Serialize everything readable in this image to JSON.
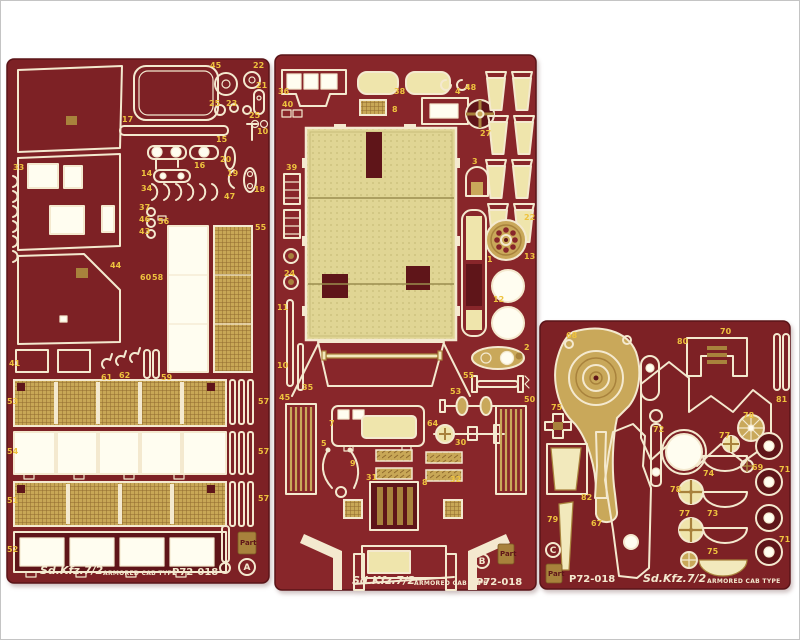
{
  "colors": {
    "fret": "#7d2125",
    "fret2": "#88262a",
    "fretdark": "#5f1519",
    "outline": "#f4e9cf",
    "bright": "#fffdf0",
    "khaki": "#efe5ac",
    "khakibright": "#f2e9bc",
    "gold": "#c9a85a",
    "golddeep": "#a8823c",
    "label": "#eec23e",
    "photobg": "#ffffff",
    "frame": "#c4c4c4"
  },
  "frets": [
    {
      "letter": "A",
      "title": "Sd.Kfz.7/2",
      "subtitle": "ARMORED CAB TYPE",
      "code": "P72-018",
      "brand": "Part",
      "labels": [
        {
          "t": "45",
          "x": 204,
          "y": 10
        },
        {
          "t": "22",
          "x": 247,
          "y": 10
        },
        {
          "t": "21",
          "x": 250,
          "y": 30
        },
        {
          "t": "25",
          "x": 203,
          "y": 48
        },
        {
          "t": "23",
          "x": 220,
          "y": 48
        },
        {
          "t": "25",
          "x": 243,
          "y": 60
        },
        {
          "t": "17",
          "x": 116,
          "y": 64
        },
        {
          "t": "15",
          "x": 210,
          "y": 84
        },
        {
          "t": "10",
          "x": 251,
          "y": 76
        },
        {
          "t": "20",
          "x": 214,
          "y": 104
        },
        {
          "t": "16",
          "x": 188,
          "y": 110
        },
        {
          "t": "19",
          "x": 221,
          "y": 118
        },
        {
          "t": "18",
          "x": 248,
          "y": 134
        },
        {
          "t": "14",
          "x": 135,
          "y": 118
        },
        {
          "t": "34",
          "x": 135,
          "y": 133
        },
        {
          "t": "47",
          "x": 218,
          "y": 141
        },
        {
          "t": "33",
          "x": 7,
          "y": 112
        },
        {
          "t": "37",
          "x": 133,
          "y": 152
        },
        {
          "t": "46",
          "x": 133,
          "y": 164
        },
        {
          "t": "43",
          "x": 133,
          "y": 176
        },
        {
          "t": "56",
          "x": 152,
          "y": 166
        },
        {
          "t": "55",
          "x": 249,
          "y": 172
        },
        {
          "t": "44",
          "x": 104,
          "y": 210
        },
        {
          "t": "60",
          "x": 134,
          "y": 222
        },
        {
          "t": "58",
          "x": 146,
          "y": 222
        },
        {
          "t": "41",
          "x": 3,
          "y": 308
        },
        {
          "t": "61",
          "x": 95,
          "y": 322
        },
        {
          "t": "62",
          "x": 113,
          "y": 320
        },
        {
          "t": "59",
          "x": 155,
          "y": 322
        },
        {
          "t": "53",
          "x": 1,
          "y": 346
        },
        {
          "t": "54",
          "x": 1,
          "y": 396
        },
        {
          "t": "51",
          "x": 1,
          "y": 445
        },
        {
          "t": "52",
          "x": 1,
          "y": 494
        },
        {
          "t": "57",
          "x": 252,
          "y": 346
        },
        {
          "t": "57",
          "x": 252,
          "y": 396
        },
        {
          "t": "57",
          "x": 252,
          "y": 443
        }
      ]
    },
    {
      "letter": "B",
      "title": "Sd.Kfz.7/2",
      "subtitle": "ARMORED CAB TYPE",
      "code": "P72-018",
      "brand": "Part",
      "labels": [
        {
          "t": "36",
          "x": 4,
          "y": 40
        },
        {
          "t": "40",
          "x": 8,
          "y": 53
        },
        {
          "t": "38",
          "x": 120,
          "y": 40
        },
        {
          "t": "8",
          "x": 118,
          "y": 58
        },
        {
          "t": "4",
          "x": 181,
          "y": 40
        },
        {
          "t": "48",
          "x": 191,
          "y": 36
        },
        {
          "t": "27",
          "x": 206,
          "y": 82
        },
        {
          "t": "3",
          "x": 198,
          "y": 110
        },
        {
          "t": "39",
          "x": 12,
          "y": 116
        },
        {
          "t": "24",
          "x": 10,
          "y": 222
        },
        {
          "t": "11",
          "x": 3,
          "y": 256
        },
        {
          "t": "10",
          "x": 3,
          "y": 314
        },
        {
          "t": "22",
          "x": 250,
          "y": 166
        },
        {
          "t": "13",
          "x": 250,
          "y": 205
        },
        {
          "t": "1",
          "x": 213,
          "y": 208
        },
        {
          "t": "12",
          "x": 219,
          "y": 248
        },
        {
          "t": "2",
          "x": 250,
          "y": 296
        },
        {
          "t": "35",
          "x": 28,
          "y": 336
        },
        {
          "t": "45",
          "x": 5,
          "y": 346
        },
        {
          "t": "55",
          "x": 189,
          "y": 324
        },
        {
          "t": "53",
          "x": 176,
          "y": 340
        },
        {
          "t": "50",
          "x": 250,
          "y": 348
        },
        {
          "t": "64",
          "x": 153,
          "y": 372
        },
        {
          "t": "7",
          "x": 55,
          "y": 372
        },
        {
          "t": "5",
          "x": 47,
          "y": 392
        },
        {
          "t": "9",
          "x": 76,
          "y": 412
        },
        {
          "t": "31",
          "x": 92,
          "y": 426
        },
        {
          "t": "30",
          "x": 181,
          "y": 391
        },
        {
          "t": "32",
          "x": 176,
          "y": 428
        },
        {
          "t": "8",
          "x": 148,
          "y": 431
        }
      ]
    },
    {
      "letter": "C",
      "title": "Sd.Kfz.7/2",
      "subtitle": "ARMORED CAB TYPE",
      "code": "P72-018",
      "brand": "Part",
      "labels": [
        {
          "t": "68",
          "x": 27,
          "y": 18
        },
        {
          "t": "70",
          "x": 181,
          "y": 14
        },
        {
          "t": "80",
          "x": 138,
          "y": 24
        },
        {
          "t": "81",
          "x": 237,
          "y": 82
        },
        {
          "t": "75",
          "x": 12,
          "y": 90
        },
        {
          "t": "72",
          "x": 114,
          "y": 112
        },
        {
          "t": "78",
          "x": 204,
          "y": 98
        },
        {
          "t": "77",
          "x": 180,
          "y": 118
        },
        {
          "t": "69",
          "x": 213,
          "y": 150
        },
        {
          "t": "71",
          "x": 240,
          "y": 152
        },
        {
          "t": "74",
          "x": 164,
          "y": 156
        },
        {
          "t": "78",
          "x": 131,
          "y": 172
        },
        {
          "t": "77",
          "x": 140,
          "y": 196
        },
        {
          "t": "73",
          "x": 168,
          "y": 196
        },
        {
          "t": "75",
          "x": 168,
          "y": 234
        },
        {
          "t": "71",
          "x": 240,
          "y": 222
        },
        {
          "t": "82",
          "x": 42,
          "y": 180
        },
        {
          "t": "79",
          "x": 8,
          "y": 202
        },
        {
          "t": "67",
          "x": 52,
          "y": 206
        }
      ]
    }
  ]
}
